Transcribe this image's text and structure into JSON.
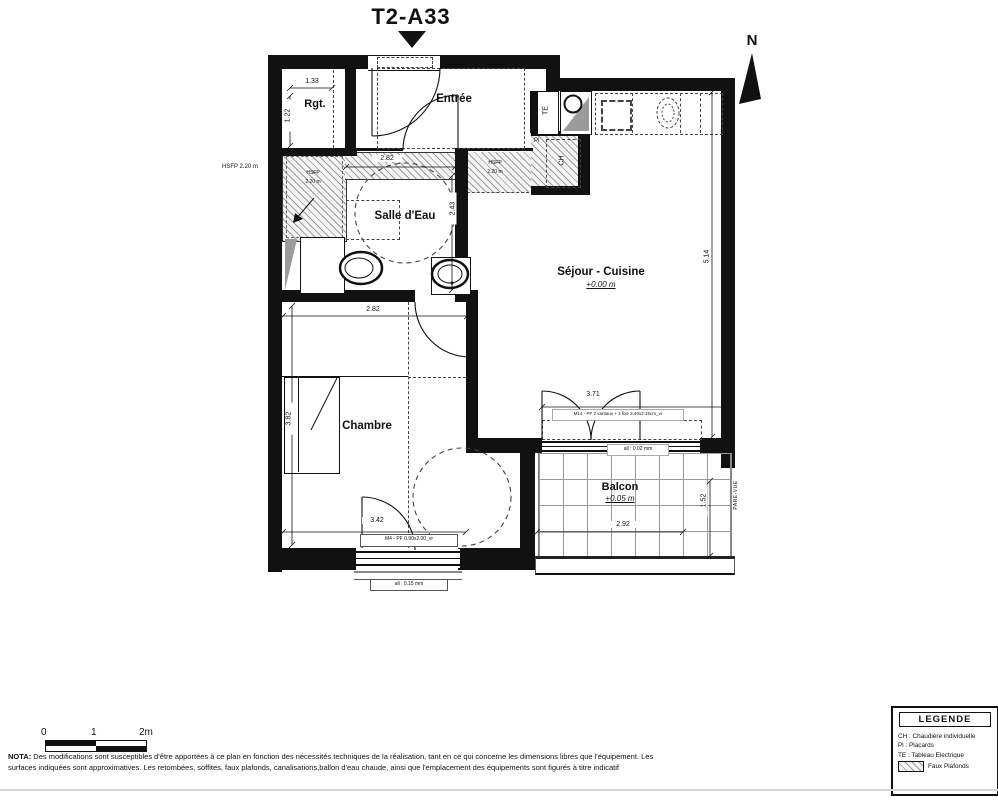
{
  "title": "T2-A33",
  "north": "N",
  "rooms": {
    "rgt": "Rgt.",
    "entree": "Entrée",
    "salle_eau": "Salle d'Eau",
    "sejour": "Séjour - Cuisine",
    "sejour_level": "+0.00 m",
    "chambre": "Chambre",
    "balcon": "Balcon",
    "balcon_level": "+0.05 m"
  },
  "equipment": {
    "te": "TE",
    "ch": "CH",
    "pl": "Pl",
    "pare_vue": "PARE-VUE"
  },
  "ceiling": {
    "hsfp_note": "HSFP 2.20 m",
    "hsfp": "HSFP",
    "hsfp_h": "2.20 m"
  },
  "dimensions": {
    "rgt_w": "1.33",
    "rgt_h": "1.22",
    "sde_w": "2.82",
    "sde_h": "2.43",
    "chambre_w": "2.82",
    "chambre_h": "3.82",
    "chambre_w2": "3.42",
    "sejour_h": "5.14",
    "sejour_door_w": "3.71",
    "balcon_w": "2.92",
    "balcon_h": "1.52"
  },
  "openings": {
    "chambre_window": "M4 - PF 0.90x2.00_vr",
    "chambre_sill": "all : 0.15 mm",
    "balcon_window": "M14 - PF 2 vantaux + 1 fixe 2.40x2.15cm_vr",
    "balcon_sill": "all : 0.02 mm"
  },
  "legend": {
    "title": "LEGENDE",
    "items": [
      "CH : Chaudière individuelle",
      "Pl : Placards",
      "TE : Tableau Electrique"
    ],
    "faux_plafonds": "Faux Plafonds"
  },
  "scale_bar": {
    "t0": "0",
    "t1": "1",
    "t2": "2m"
  },
  "nota": {
    "label": "NOTA:",
    "text": "Des modifications sont susceptibles d'être apportées à ce plan en fonction des nécessités techniques de la réalisation, tant en ce qui concerne les dimensions libres que l'équipement. Les surfaces indiquées sont approximatives. Les retombées, soffites, faux plafonds, canalisations,ballon d'eau chaude, ainsi que l'emplacement des équipements sont figurés à titre indicatif"
  }
}
